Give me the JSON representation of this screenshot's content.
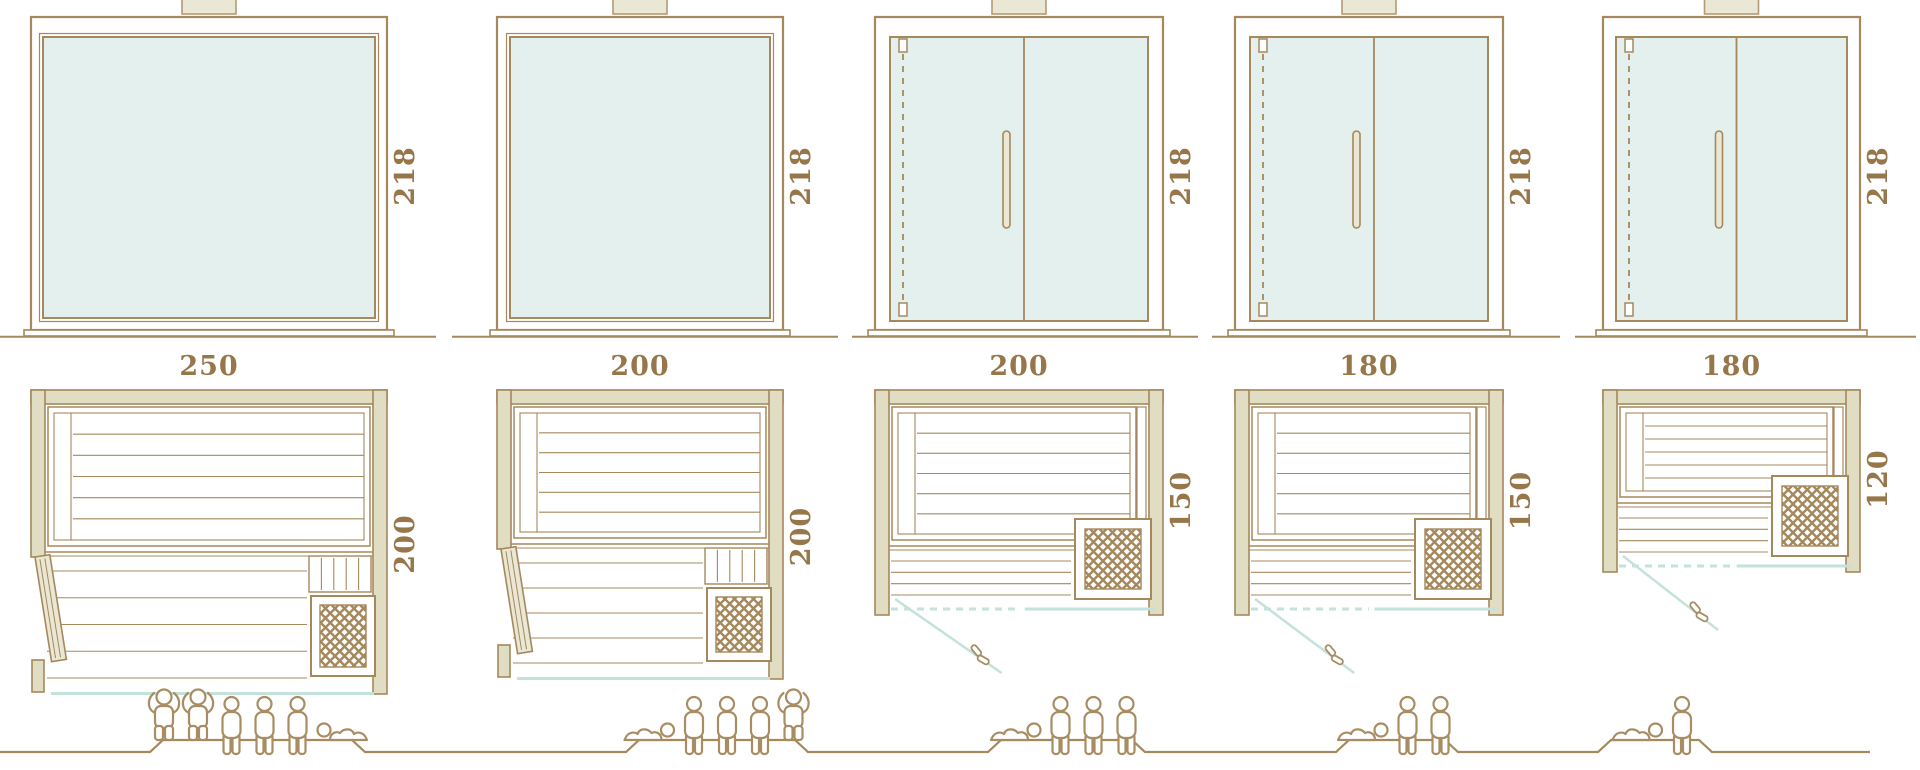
{
  "diagram": {
    "kind": "sauna-model-size-lineup",
    "views": [
      "front-elevation",
      "floor-plan",
      "capacity-figures"
    ]
  },
  "colors": {
    "line_brown": "#a5885c",
    "text_brown": "#97764a",
    "glass_fill": "#e3f0ed",
    "teal_line": "#c3e2dc",
    "wall_fill": "#e0ddc3",
    "panel_fill": "#eae7d5",
    "figure_brown": "#a88d62",
    "white": "#ffffff"
  },
  "columns": [
    {
      "id": "model-250x200",
      "height_label": "218",
      "width_label": "250",
      "depth_label": "200",
      "front_type": "fixed-glass-panel",
      "door": "side-hinged-door-open",
      "heater": "bottom-right-lattice-stove",
      "people": {
        "standing": 2,
        "sitting": 3,
        "lying": 1,
        "total": 6
      }
    },
    {
      "id": "model-200x200",
      "height_label": "218",
      "width_label": "200",
      "depth_label": "200",
      "front_type": "fixed-glass-panel",
      "door": "side-hinged-door-open",
      "heater": "bottom-right-lattice-stove",
      "people": {
        "standing": 1,
        "sitting": 3,
        "lying": 1,
        "total": 5
      }
    },
    {
      "id": "model-200x150",
      "height_label": "218",
      "width_label": "200",
      "depth_label": "150",
      "front_type": "glass-double-door-with-handle",
      "door": "front-glass-door-swing",
      "heater": "bottom-right-lattice-stove",
      "people": {
        "standing": 0,
        "sitting": 3,
        "lying": 1,
        "total": 4
      }
    },
    {
      "id": "model-180x150",
      "height_label": "218",
      "width_label": "180",
      "depth_label": "150",
      "front_type": "glass-double-door-with-handle",
      "door": "front-glass-door-swing",
      "heater": "bottom-right-lattice-stove",
      "people": {
        "standing": 0,
        "sitting": 2,
        "lying": 1,
        "total": 3
      }
    },
    {
      "id": "model-180x120",
      "height_label": "218",
      "width_label": "180",
      "depth_label": "120",
      "front_type": "glass-double-door-with-handle",
      "door": "front-glass-door-swing",
      "heater": "bottom-right-lattice-stove",
      "people": {
        "standing": 0,
        "sitting": 1,
        "lying": 1,
        "total": 2
      }
    }
  ]
}
